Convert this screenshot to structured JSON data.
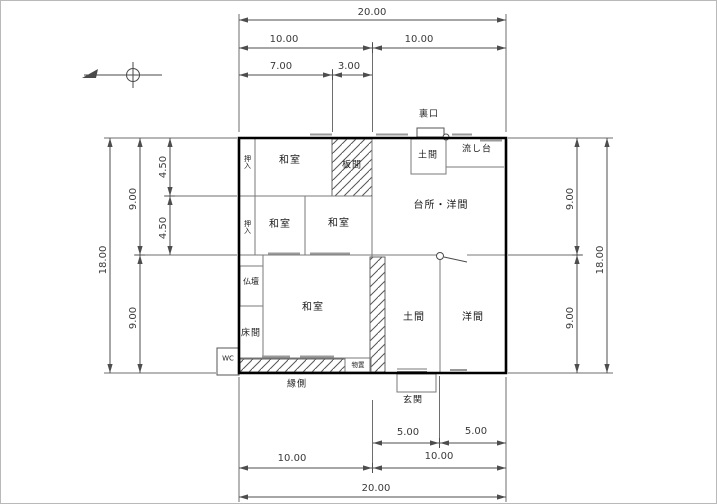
{
  "rooms": {
    "washitsu_nw": {
      "label": "和室"
    },
    "itanoma": {
      "label": "板間"
    },
    "oshiire_top": {
      "label": "押入"
    },
    "oshiire_mid": {
      "label": "押入"
    },
    "washitsu_c1": {
      "label": "和室"
    },
    "washitsu_c2": {
      "label": "和室"
    },
    "daidokoro_yoma": {
      "label": "台所・洋間"
    },
    "doma_top": {
      "label": "土間"
    },
    "nagashidai": {
      "label": "流し台"
    },
    "uraguchi": {
      "label": "裏口"
    },
    "butsudan": {
      "label": "仏壇"
    },
    "tokonoma": {
      "label": "床間"
    },
    "washitsu_main": {
      "label": "和室"
    },
    "doma": {
      "label": "土間"
    },
    "yoma": {
      "label": "洋間"
    },
    "engawa": {
      "label": "縁側"
    },
    "monooki": {
      "label": "物置"
    },
    "genkan": {
      "label": "玄関"
    },
    "wc": {
      "label": "WC"
    }
  },
  "dimensions": {
    "top": {
      "total": "20.00",
      "half_left": "10.00",
      "half_right": "10.00",
      "sub_left": "7.00",
      "sub_right": "3.00"
    },
    "left": {
      "total": "18.00",
      "half_top": "9.00",
      "half_bottom": "9.00",
      "sub_top": "4.50",
      "sub_bottom": "4.50"
    },
    "right": {
      "total": "18.00",
      "half_top": "9.00",
      "half_bottom": "9.00"
    },
    "bottom": {
      "total": "20.00",
      "half_left": "10.00",
      "half_right": "10.00",
      "sub_left": "5.00",
      "sub_right": "5.00"
    }
  },
  "colors": {
    "wall": "#000000",
    "interior_line": "#7a7a7a",
    "dimension_line": "#4d4d4d",
    "hatch": "#555555",
    "text": "#1c1c1c",
    "background": "#ffffff"
  }
}
